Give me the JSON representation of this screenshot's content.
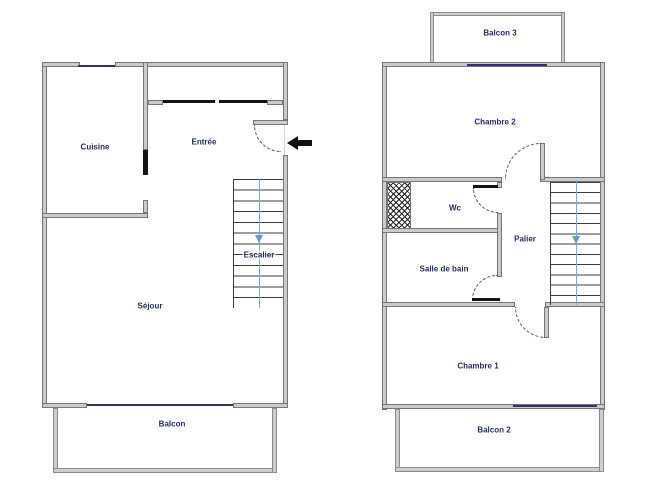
{
  "colors": {
    "wall_fill": "#cbcbcb",
    "wall_border": "#757575",
    "label_text": "#262b6e",
    "window_line": "#30336a",
    "stair_arrow_blue": "#5f9bd3",
    "entrance_arrow_black": "#111111",
    "background": "#ffffff"
  },
  "floor1": {
    "labels": {
      "cuisine": "Cuisine",
      "entree": "Entrée",
      "sejour": "Séjour",
      "escalier": "Escalier",
      "balcon": "Balcon"
    }
  },
  "floor2": {
    "labels": {
      "balcon3": "Balcon 3",
      "chambre2": "Chambre 2",
      "wc": "Wc",
      "palier": "Palier",
      "salle_de_bain": "Salle de bain",
      "chambre1": "Chambre 1",
      "balcon2": "Balcon 2"
    }
  }
}
